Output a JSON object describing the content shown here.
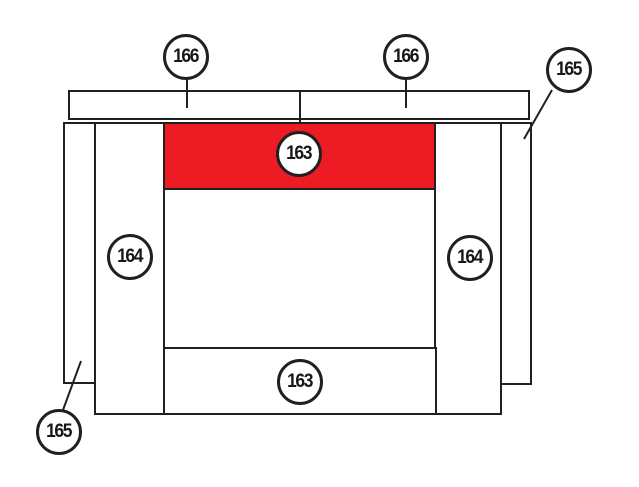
{
  "diagram": {
    "title": "firebox-lining-parts-diagram",
    "colors": {
      "background": "#FFFFFF",
      "line": "#231F20",
      "highlight": "#ED1C24"
    },
    "callouts": [
      {
        "part": "166",
        "position": "top-bar-left-half"
      },
      {
        "part": "166",
        "position": "top-bar-right-half"
      },
      {
        "part": "165",
        "position": "outer-side-panel-right"
      },
      {
        "part": "164",
        "position": "side-brick-left"
      },
      {
        "part": "164",
        "position": "side-brick-right"
      },
      {
        "part": "163",
        "position": "baffle-plate-top",
        "highlighted": true
      },
      {
        "part": "163",
        "position": "base-plate-bottom"
      },
      {
        "part": "165",
        "position": "outer-side-panel-left"
      }
    ]
  }
}
